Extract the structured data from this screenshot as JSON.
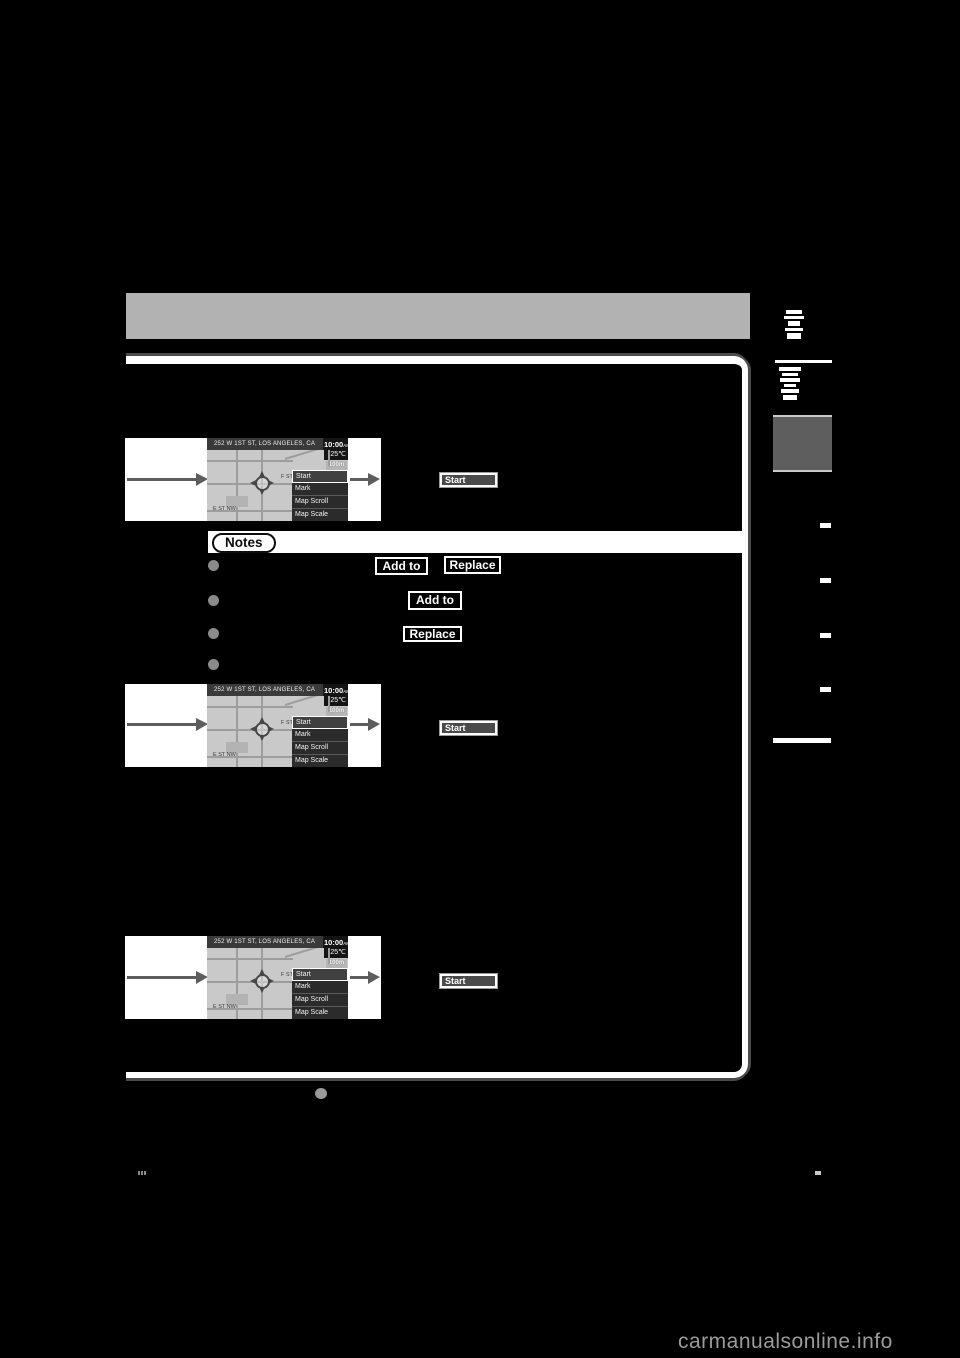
{
  "page": {
    "watermark": "carmanualsonline.info",
    "background": "#000000"
  },
  "header": {
    "bar_color": "#b2b2b2"
  },
  "map_screen": {
    "address": "252 W 1ST ST, LOS ANGELES, CA",
    "time": "10:00",
    "meridiem": "AM",
    "temperature": "25℃",
    "scale": "100m",
    "street_label_1": "F ST",
    "street_label_2": "E ST NW",
    "menu": [
      "Start",
      "Mark",
      "Map Scroll",
      "Map Scale"
    ]
  },
  "steps": [
    {
      "button_label": "Start"
    },
    {
      "button_label": "Start"
    },
    {
      "button_label": "Start"
    }
  ],
  "notes": {
    "title": "Notes",
    "bullets": [
      {
        "buttons": [
          "Add to",
          "Replace"
        ]
      },
      {
        "buttons": [
          "Add to"
        ]
      },
      {
        "buttons": [
          "Replace"
        ]
      },
      {
        "buttons": []
      }
    ]
  },
  "colors": {
    "panel_border": "#ffffff",
    "panel_shadow": "#4b4b4b",
    "map_background": "#c9c9c9",
    "map_header": "#3a3a3a",
    "chip_border": "#ffffff",
    "bullet": "#8a8a8a",
    "chapter_tab": "#5e5e5e",
    "watermark_text": "#9b9b9b"
  }
}
